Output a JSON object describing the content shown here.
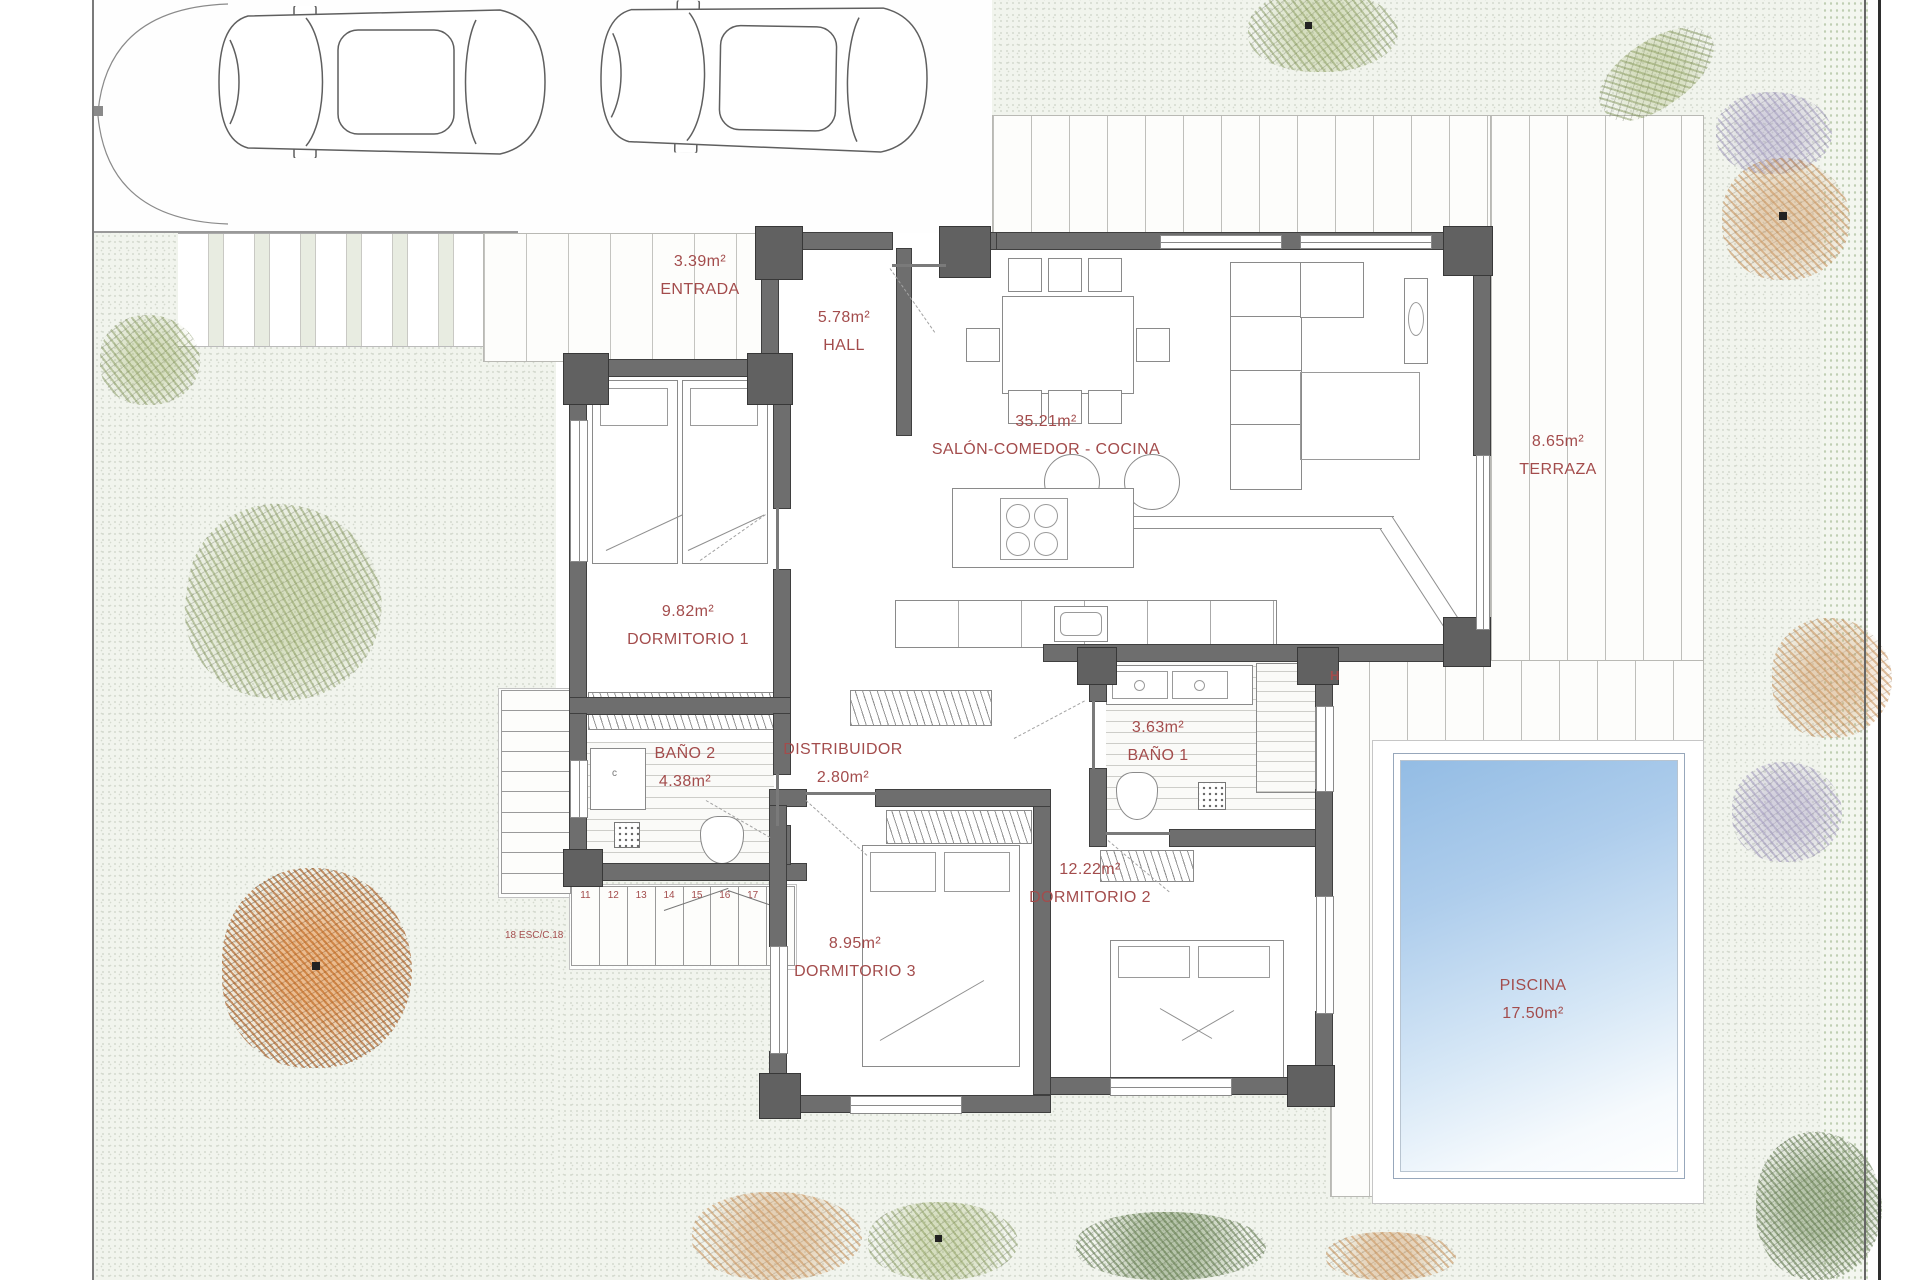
{
  "colors": {
    "accent": "#a34c4c",
    "wall": "#6e6e6e",
    "pool": "#9cc0e6",
    "garden": "#f1f4ed"
  },
  "plan": {
    "rooms": [
      {
        "id": "entrada",
        "name": "ENTRADA",
        "area": "3.39m²"
      },
      {
        "id": "hall",
        "name": "HALL",
        "area": "5.78m²"
      },
      {
        "id": "salon-comedor-cocina",
        "name": "SALÓN-COMEDOR - COCINA",
        "area": "35.21m²"
      },
      {
        "id": "terraza",
        "name": "TERRAZA",
        "area": "8.65m²"
      },
      {
        "id": "dormitorio-1",
        "name": "DORMITORIO 1",
        "area": "9.82m²"
      },
      {
        "id": "bano-2",
        "name": "BAÑO 2",
        "area": "4.38m²"
      },
      {
        "id": "distribuidor",
        "name": "DISTRIBUIDOR",
        "area": "2.80m²"
      },
      {
        "id": "bano-1",
        "name": "BAÑO 1",
        "area": "3.63m²"
      },
      {
        "id": "dormitorio-2",
        "name": "DORMITORIO 2",
        "area": "12.22m²"
      },
      {
        "id": "dormitorio-3",
        "name": "DORMITORIO 3",
        "area": "8.95m²"
      },
      {
        "id": "piscina",
        "name": "PISCINA",
        "area": "17.50m²"
      }
    ],
    "stairs": {
      "steps_down": [
        "1",
        "2",
        "3",
        "4",
        "5",
        "6",
        "7",
        "8",
        "9",
        "10"
      ],
      "steps_across": [
        "11",
        "12",
        "13",
        "14",
        "15",
        "16",
        "17",
        "18"
      ],
      "label": "18 ESC/C.18"
    },
    "wall_marker": "H"
  }
}
